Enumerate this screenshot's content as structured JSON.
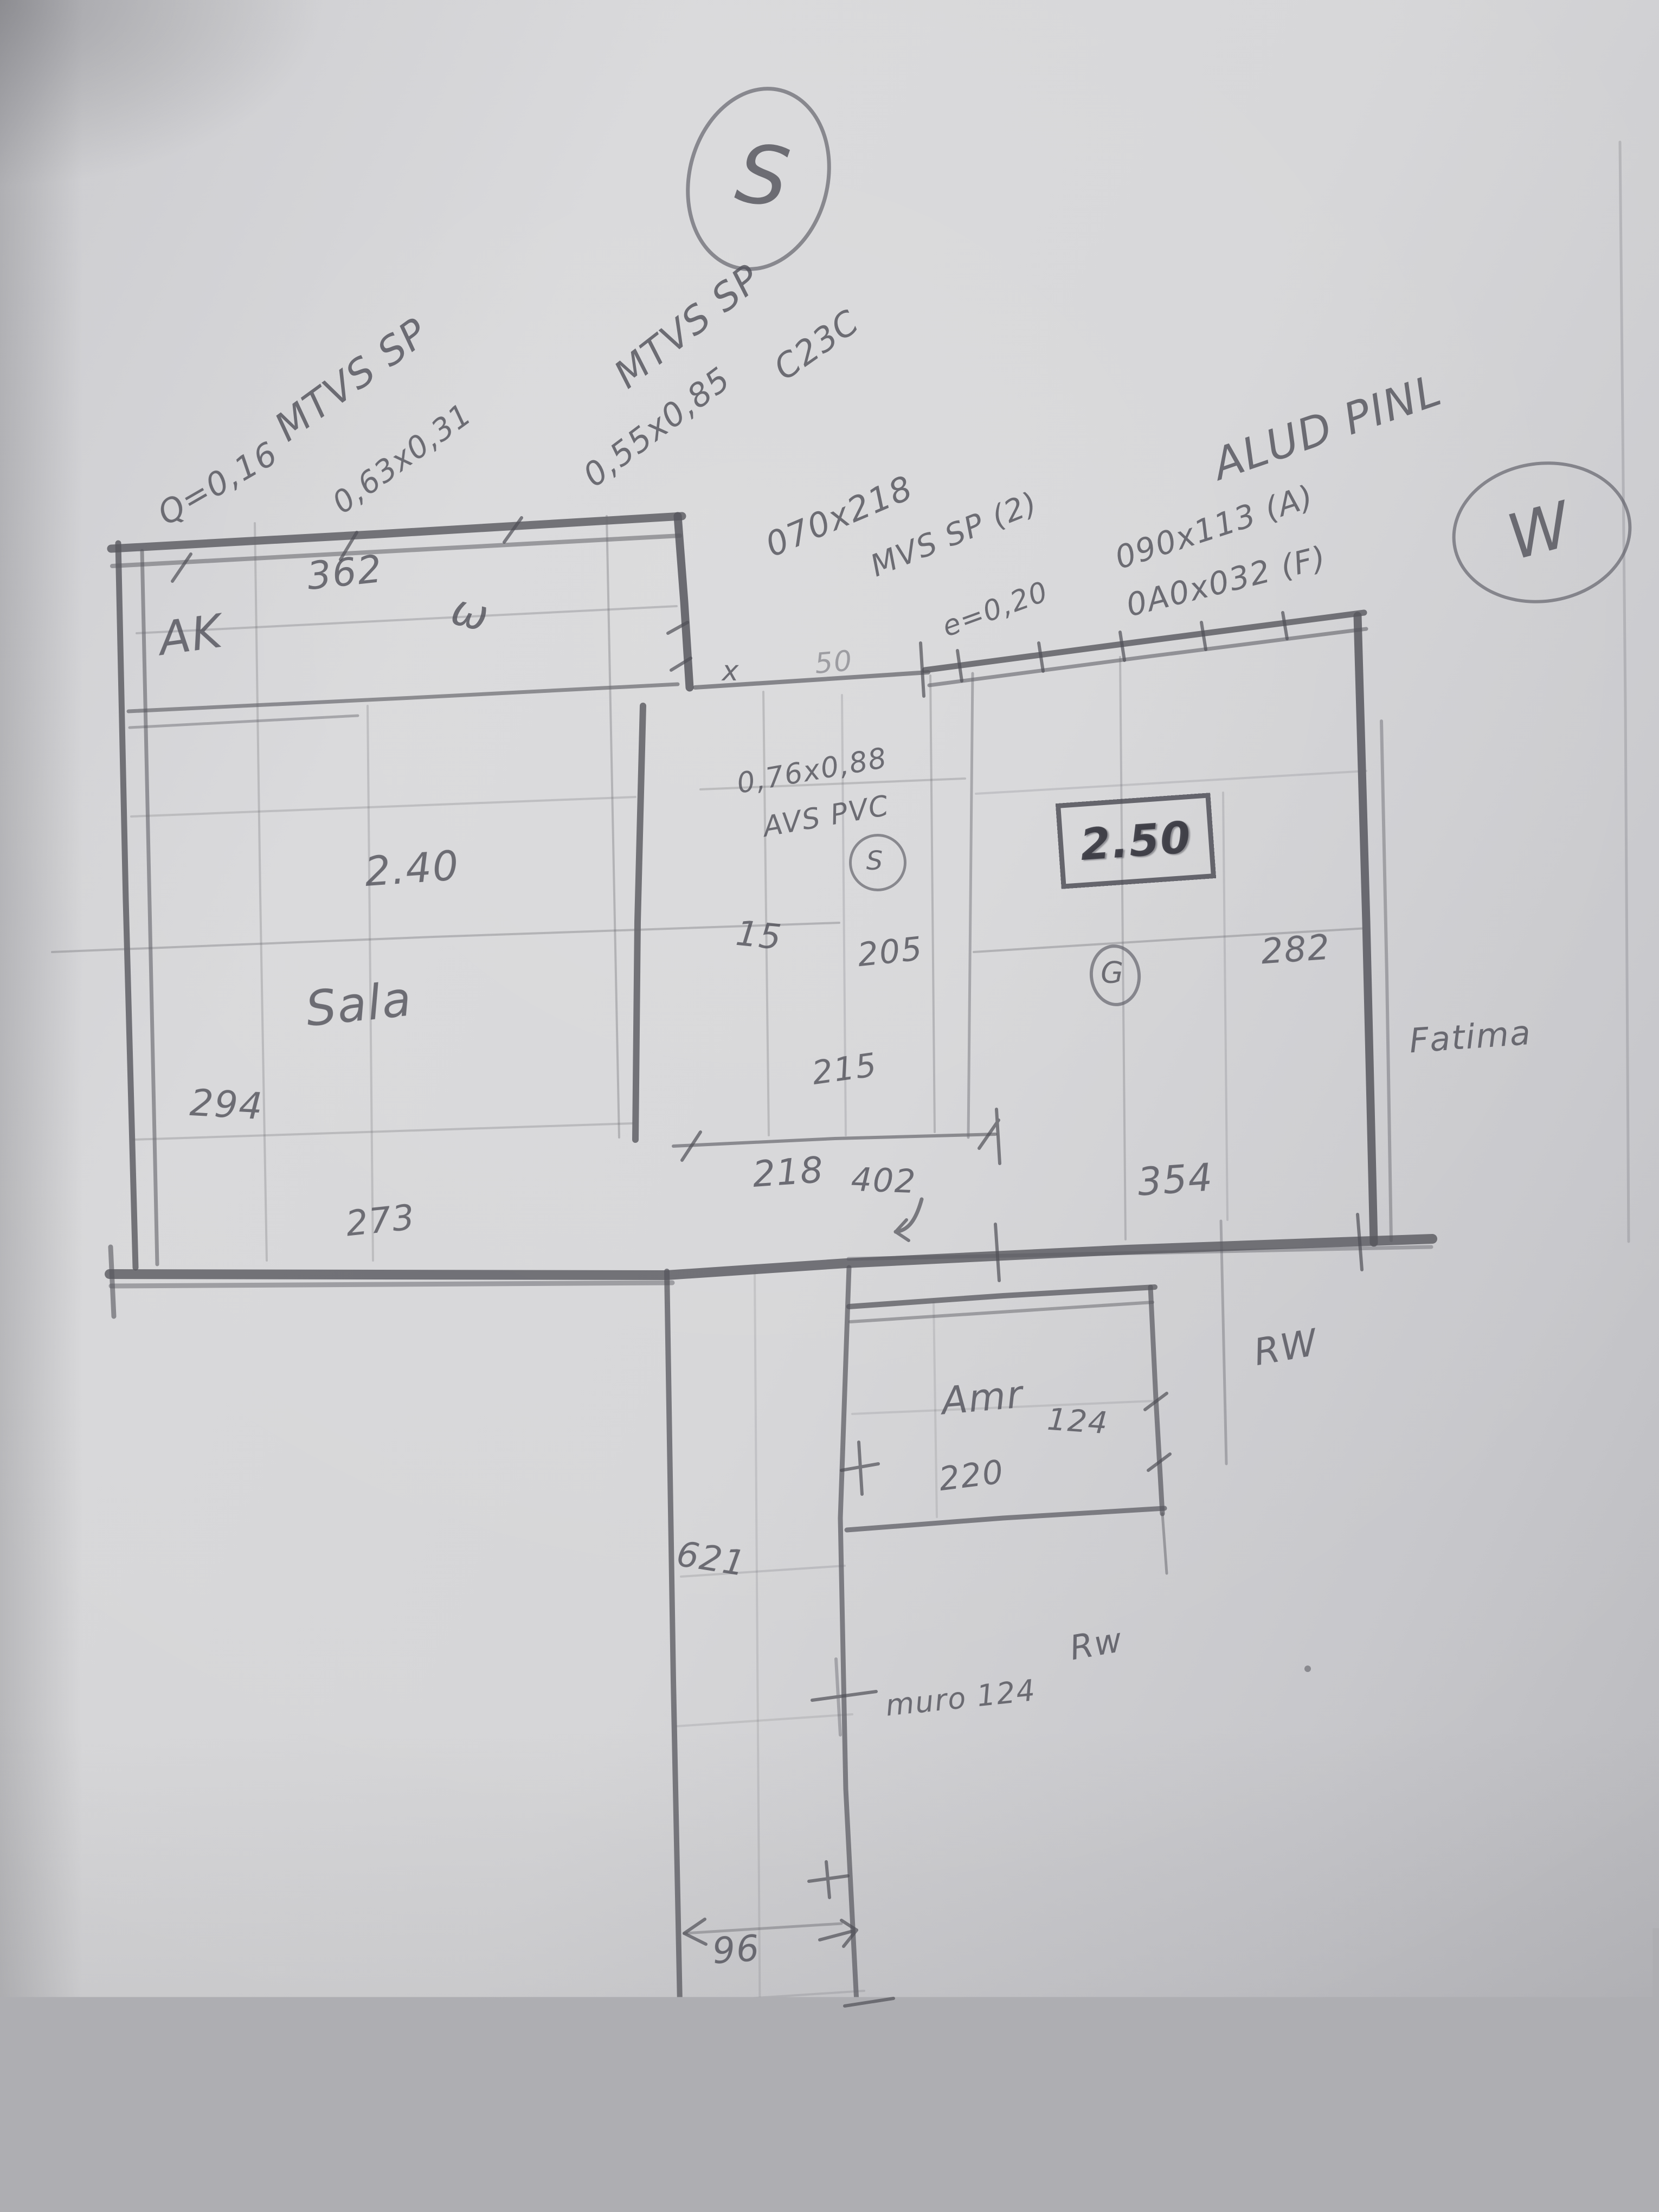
{
  "compass": {
    "south": "S",
    "west": "W"
  },
  "annotations": {
    "left": {
      "l1": "MTVS SP",
      "l2": "Q=0,16",
      "l3": "0,63x0,31"
    },
    "center": {
      "l1": "MTVS SP",
      "l2": "C23C",
      "l3": "0,55x0,85"
    },
    "door": {
      "l1": "070x218",
      "l2": "MVS SP (2)",
      "l3": "e=0,20"
    },
    "right": {
      "l1": "ALUD PINL",
      "l2": "090x113 (A)",
      "l3": "0A0x032 (F)"
    },
    "pvc": {
      "l1": "0,76x0,88",
      "l2": "AVS PVC",
      "badge": "S"
    }
  },
  "rooms": {
    "ak": "AK",
    "sala": "Sala",
    "amr": "Amr",
    "fatima": "Fatima",
    "rw_side": "RW",
    "rw_lower": "Rw",
    "muro": "muro 124",
    "strip_mark": "ω"
  },
  "badges": {
    "g": "G"
  },
  "dims": {
    "d362": "362",
    "d240": "2.40",
    "d294": "294",
    "d273": "273",
    "d15": "15",
    "d205": "205",
    "d215": "215",
    "d218": "218",
    "d250": "2.50",
    "d282": "282",
    "d402": "402",
    "d354": "354",
    "d124": "124",
    "d220": "220",
    "d621": "621",
    "d96": "96",
    "x_mark": "x",
    "d50": "50"
  }
}
